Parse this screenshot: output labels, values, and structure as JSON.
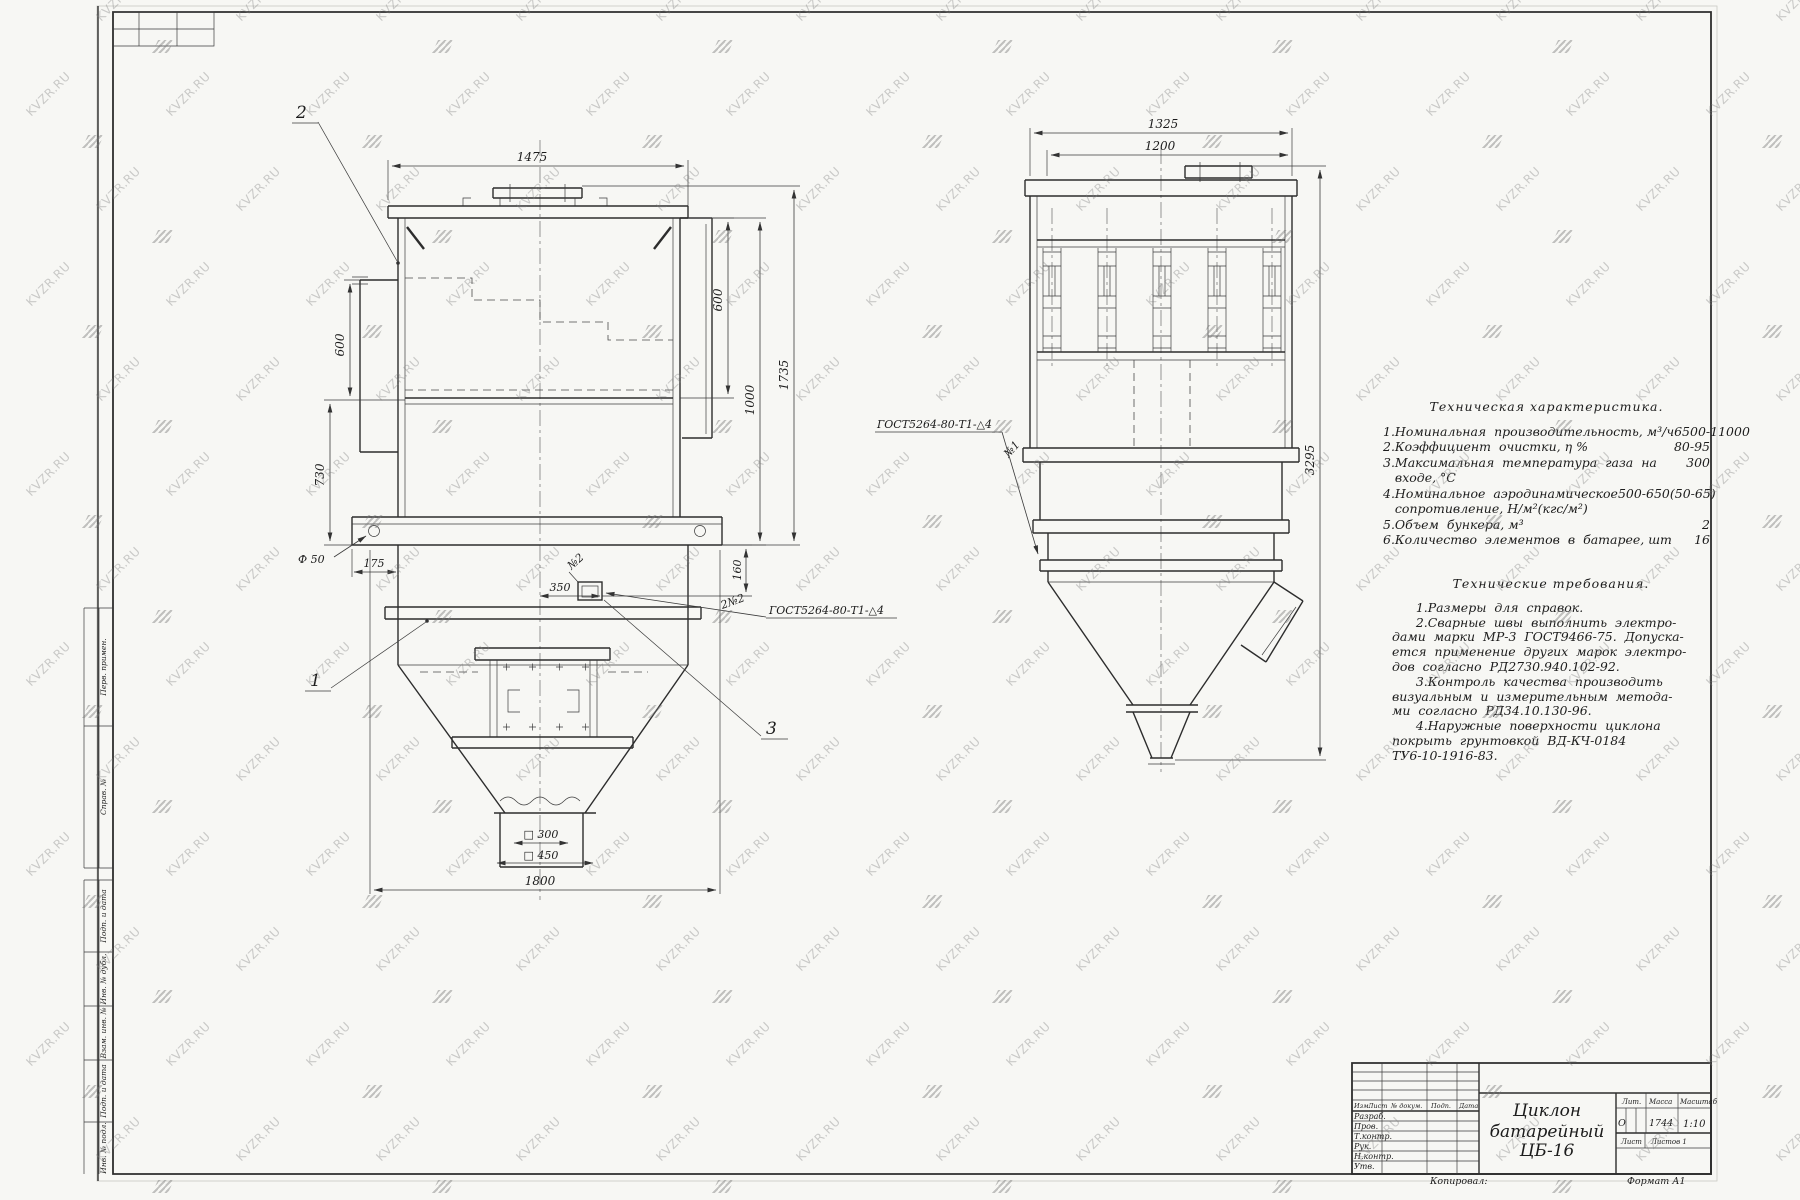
{
  "watermark": {
    "text": "KVZR.RU"
  },
  "margin": {
    "labels": [
      "Перв. примен.",
      "Справ. №",
      "Подп. и дата",
      "Инв. № дубл.",
      "Взам. инв. №",
      "Подп. и дата",
      "Инв. № подл."
    ]
  },
  "tech_char": {
    "title": "Техническая характеристика.",
    "lines": [
      {
        "t": "1.Номинальная  производительность, м³/ч",
        "v": "6500-11000"
      },
      {
        "t": "2.Коэффициент  очистки, η %",
        "v": "80-95"
      },
      {
        "t": "3.Максимальная  температура  газа  на",
        "v": "300"
      },
      {
        "t": "   входе, °С",
        "v": ""
      },
      {
        "t": "4.Номинальное  аэродинамическое",
        "v": "500-650(50-65)"
      },
      {
        "t": "   сопротивление, Н/м²(кгс/м²)",
        "v": ""
      },
      {
        "t": "5.Объем  бункера, м³",
        "v": "2"
      },
      {
        "t": "6.Количество  элементов  в  батарее, шт",
        "v": "16"
      }
    ]
  },
  "tech_req": {
    "title": "Технические  требования.",
    "lines": [
      "      1.Размеры  для  справок.",
      "      2.Сварные  швы  выполнить  электро-",
      "дами  марки  МР-3  ГОСТ9466-75.  Допуска-",
      "ется  применение  других  марок  электро-",
      "дов  согласно  РД2730.940.102-92.",
      "      3.Контроль  качества  производить",
      "визуальным  и  измерительным  метода-",
      "ми  согласно  РД34.10.130-96.",
      "      4.Наружные  поверхности  циклона",
      "покрыть  грунтовкой  ВД-КЧ-0184",
      "ТУ6-10-1916-83."
    ]
  },
  "front": {
    "c1": "1",
    "c2": "2",
    "c3": "3",
    "d1475": "1475",
    "d600l": "600",
    "d730": "730",
    "d600r": "600",
    "d1000": "1000",
    "d1735": "1735",
    "dphi50": "Ф 50",
    "d175": "175",
    "d350": "350",
    "d160": "160",
    "dsq300": "□ 300",
    "dsq450": "□ 450",
    "d1800": "1800",
    "weld_qty": "2№2",
    "weld": "ГОСТ5264-80-Т1-△4",
    "no2": "№2"
  },
  "side": {
    "d1325": "1325",
    "d1200": "1200",
    "d3295": "3295",
    "weld": "ГОСТ5264-80-Т1-△4",
    "no1": "№1"
  },
  "title_block": {
    "doc_title_l1": "Циклон",
    "doc_title_l2": "батарейный",
    "doc_title_l3": "ЦБ-16",
    "header": [
      "Изм.",
      "Лист",
      "№ докум.",
      "Подп.",
      "Дата"
    ],
    "rows": [
      "Разраб.",
      "Пров.",
      "Т.контр.",
      "Рук.",
      "Н.контр.",
      "Утв."
    ],
    "lit_label": "Лит.",
    "mass_label": "Масса",
    "scale_label": "Масштаб",
    "lit_value": "О",
    "mass_value": "1744",
    "scale_value": "1:10",
    "sheet_label": "Лист",
    "sheets_label": "Листов 1"
  },
  "sheet": {
    "kopiroval": "Копировал:",
    "format": "Формат А1"
  }
}
